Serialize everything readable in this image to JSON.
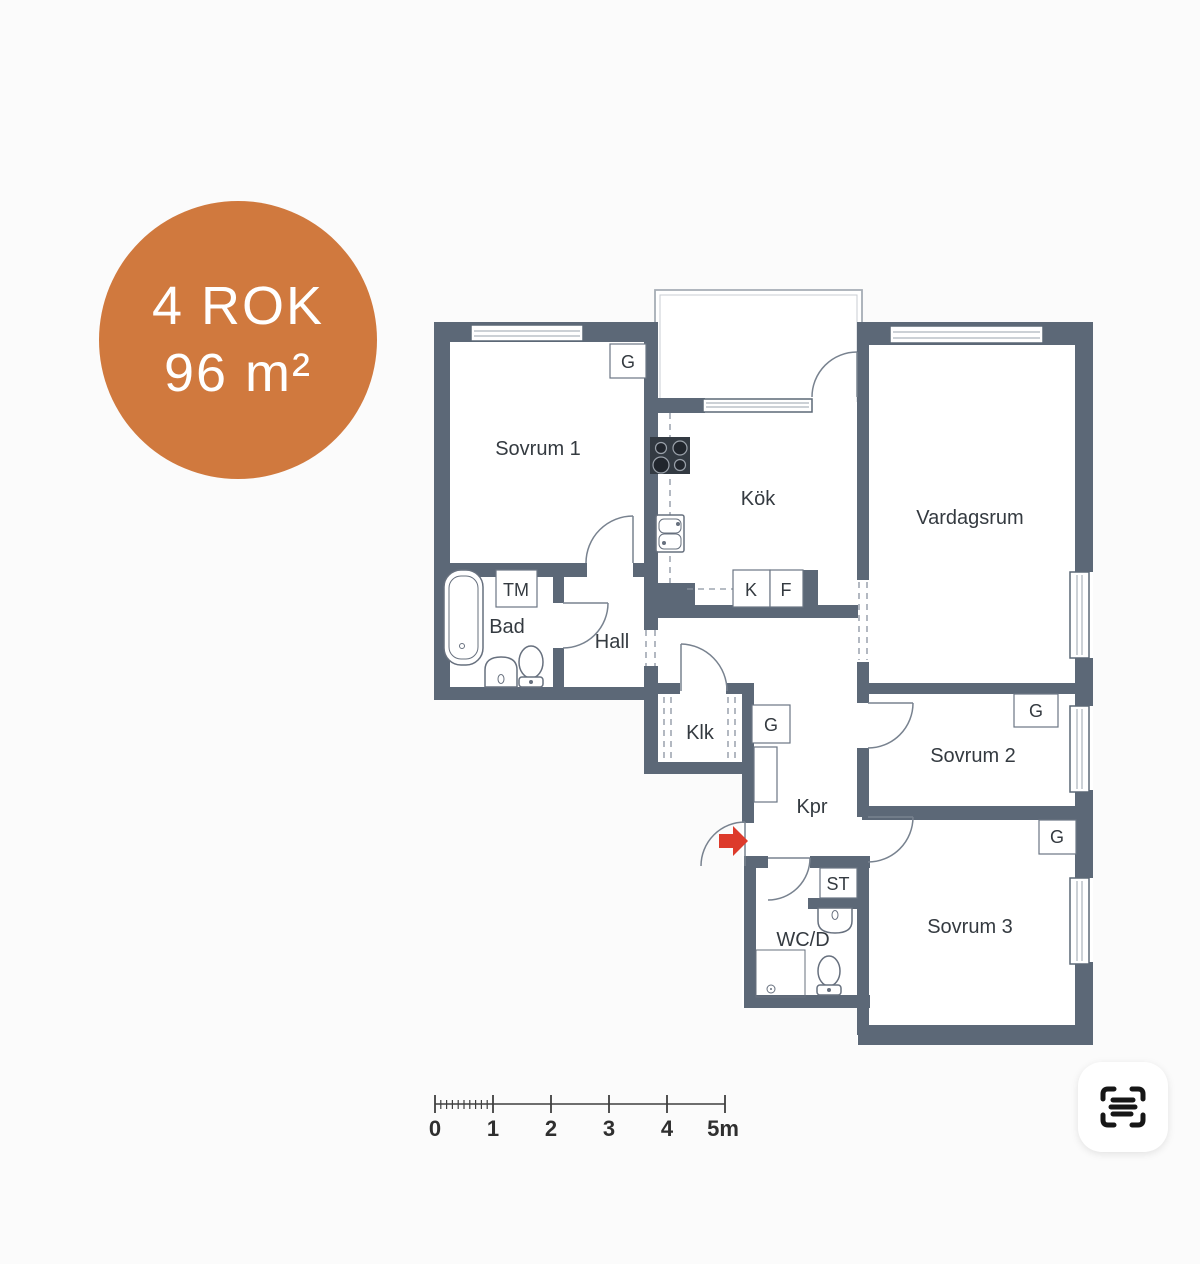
{
  "badge": {
    "line1": "4 ROK",
    "line2": "96 m²",
    "bg": "#d0793e",
    "fg": "#ffffff"
  },
  "plan": {
    "wall_color": "#5c6877",
    "entrance_arrow_color": "#dd3a2b",
    "rooms": {
      "sovrum1": "Sovrum 1",
      "kok": "Kök",
      "vardagsrum": "Vardagsrum",
      "bad": "Bad",
      "hall": "Hall",
      "klk": "Klk",
      "kpr": "Kpr",
      "sovrum2": "Sovrum 2",
      "sovrum3": "Sovrum 3",
      "wcd": "WC/D"
    },
    "closets": {
      "g1": "G",
      "g2": "G",
      "g3": "G",
      "g4": "G"
    },
    "appliances": {
      "tm": "TM",
      "k": "K",
      "f": "F",
      "st": "ST"
    }
  },
  "scalebar": {
    "labels": [
      "0",
      "1",
      "2",
      "3",
      "4",
      "5m"
    ]
  },
  "lens_button": {
    "icon": "scan-frame-icon"
  }
}
